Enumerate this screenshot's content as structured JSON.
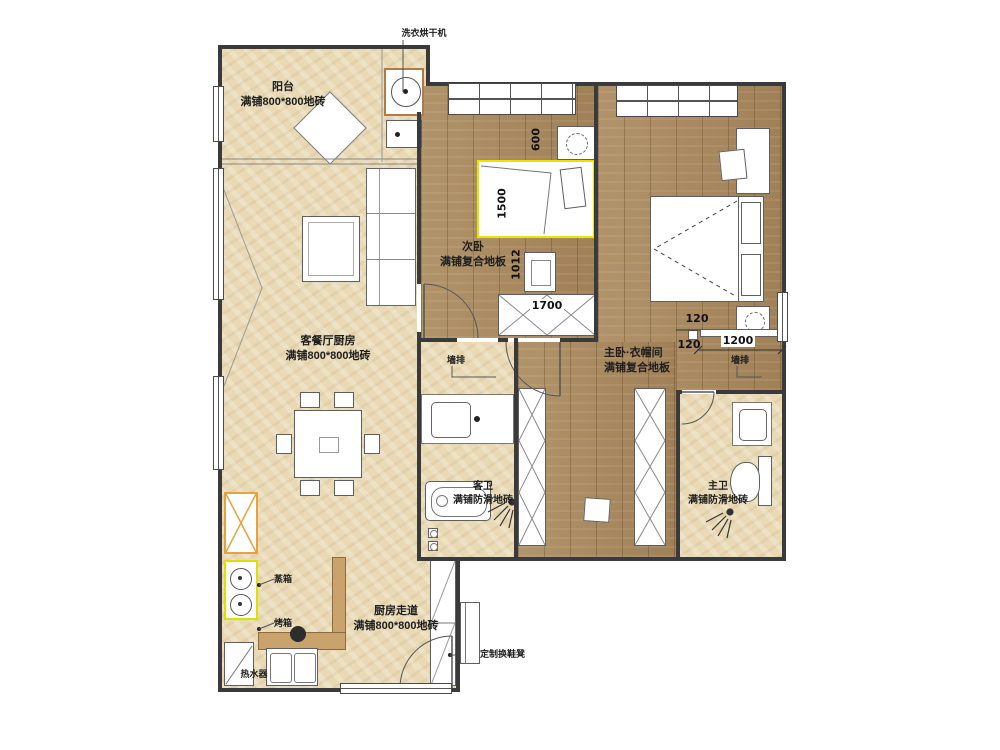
{
  "plan": {
    "rooms": {
      "balcony": {
        "name": "阳台",
        "floor": "满铺800*800地砖"
      },
      "living": {
        "name": "客餐厅厨房",
        "floor": "满铺800*800地砖"
      },
      "bedroom2": {
        "name": "次卧",
        "floor": "满铺复合地板"
      },
      "master": {
        "name": "主卧·衣帽间",
        "floor": "满铺复合地板"
      },
      "guest_bath": {
        "name": "客卫",
        "floor": "满铺防滑地砖"
      },
      "master_bath": {
        "name": "主卫",
        "floor": "满铺防滑地砖"
      },
      "corridor": {
        "name": "厨房走道",
        "floor": "满铺800*800地砖"
      }
    },
    "annotations": {
      "washer_dryer": "洗衣烘干机",
      "bench": "定制换鞋凳",
      "water_heater": "热水器",
      "steam_oven": "蒸箱",
      "oven": "烤箱",
      "wall_drain_left": "墙排",
      "wall_drain_right": "墙排"
    },
    "dimensions": {
      "nightstand_600": "600",
      "bed_1500": "1500",
      "desk_1012": "1012",
      "wardrobe_1700": "1700",
      "jamb_120_top": "120",
      "jamb_120_bottom": "120",
      "opening_1200": "1200"
    },
    "colors": {
      "tile": "#e9dab5",
      "wood": "#a9895e",
      "wall": "#3a3a3a",
      "bed_highlight": "#ece400",
      "stove_highlight": "#dde000",
      "cabinet_highlight": "#e8a23c"
    }
  }
}
